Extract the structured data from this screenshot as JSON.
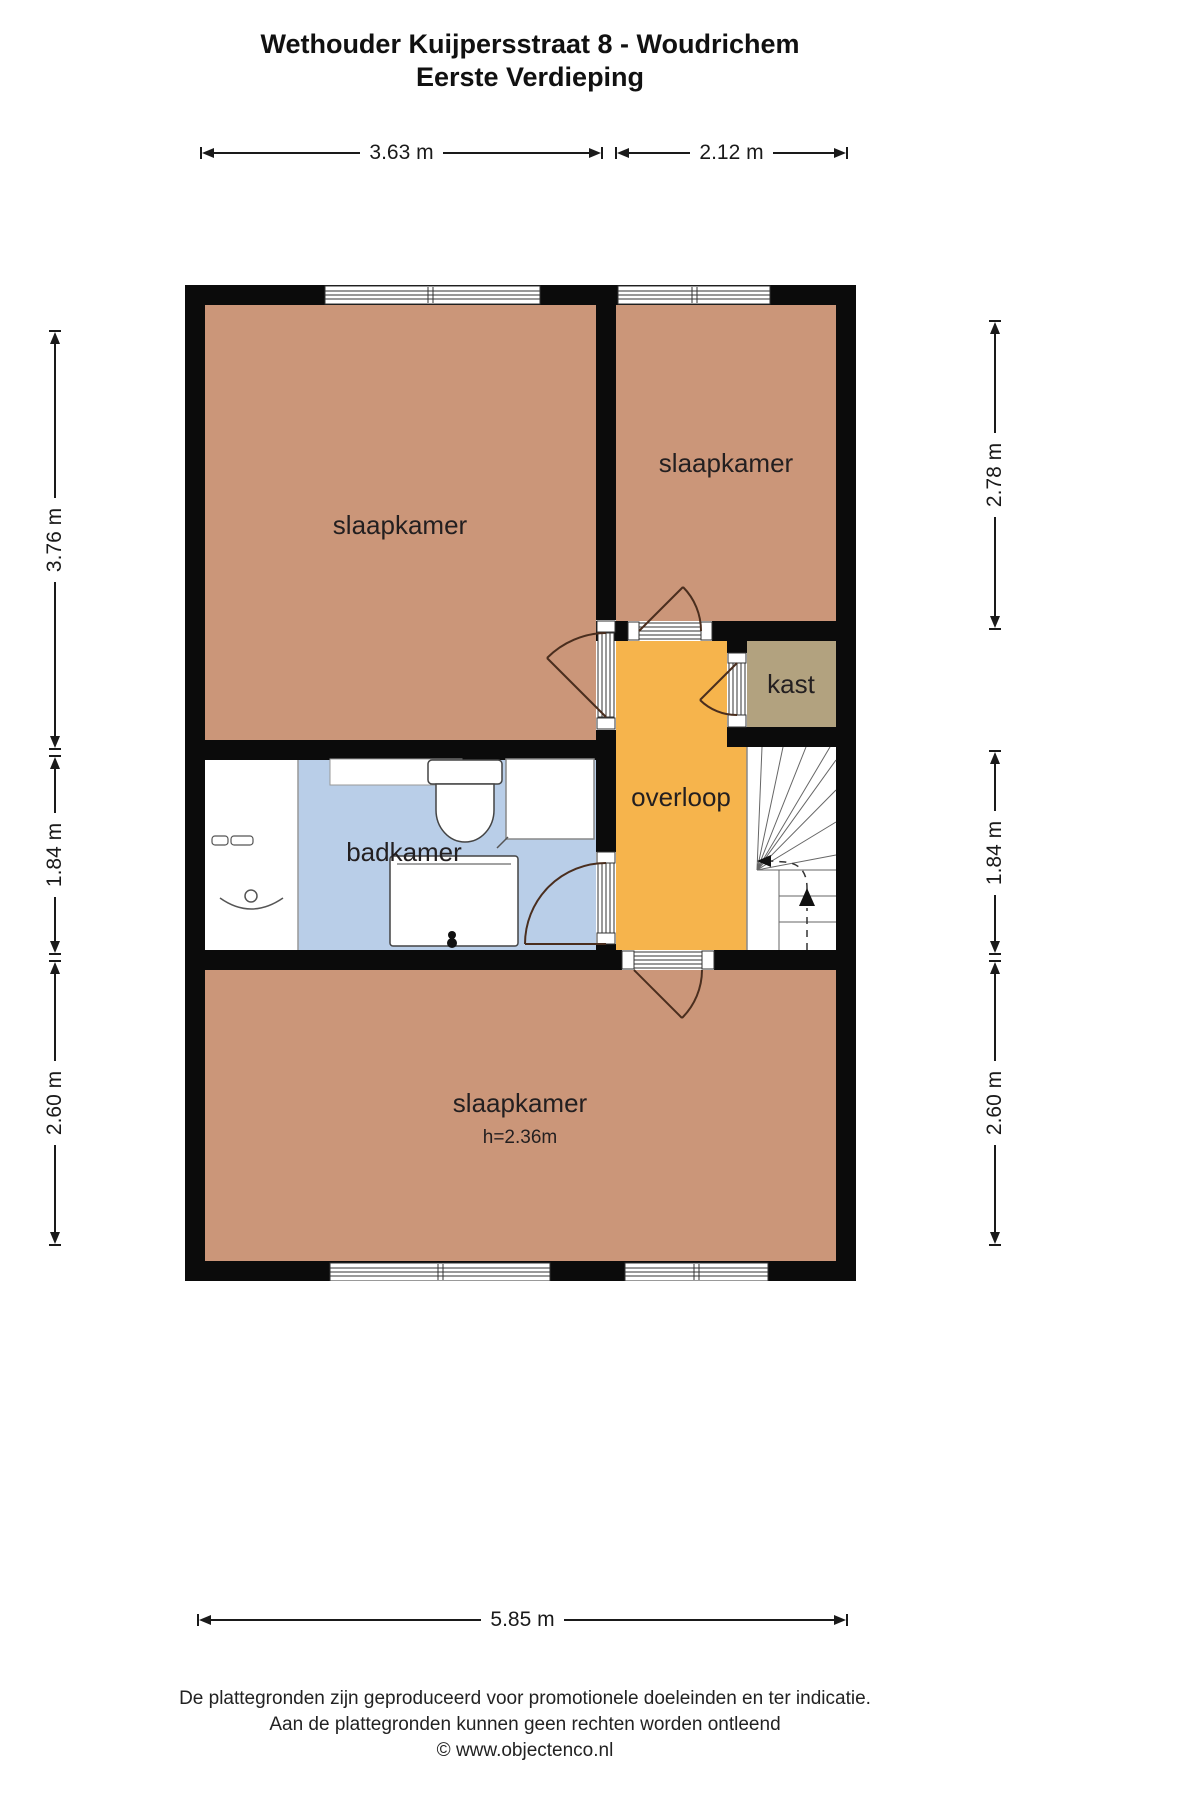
{
  "header": {
    "title_line1": "Wethouder Kuijpersstraat 8 - Woudrichem",
    "title_line2": "Eerste Verdieping"
  },
  "rooms": {
    "bedroom_top_left": "slaapkamer",
    "bedroom_top_right": "slaapkamer",
    "closet": "kast",
    "landing": "overloop",
    "bathroom": "badkamer",
    "bedroom_bottom": "slaapkamer",
    "bedroom_bottom_height": "h=2.36m"
  },
  "fixtures": [
    "toilet",
    "bathtub",
    "washbasin",
    "shower",
    "shelf",
    "stairs"
  ],
  "dimensions": {
    "top": [
      "3.63 m",
      "2.12 m"
    ],
    "left": [
      "3.76 m",
      "1.84 m",
      "2.60 m"
    ],
    "right": [
      "2.78 m",
      "1.84 m",
      "2.60 m"
    ],
    "bottom": [
      "5.85 m"
    ]
  },
  "footer": {
    "disclaimer_line1": "De plattegronden zijn geproduceerd voor promotionele doeleinden en ter indicatie.",
    "disclaimer_line2": "Aan de plattegronden kunnen geen rechten worden ontleend",
    "copyright": "© www.objectenco.nl"
  },
  "colors": {
    "wall": "#0b0b0b",
    "bedroom": "#cb9679",
    "landing": "#f6b44c",
    "closet": "#b2a27f",
    "bathroom": "#b9cee8",
    "fixture_white": "#ffffff",
    "door": "#4a2e1e"
  }
}
